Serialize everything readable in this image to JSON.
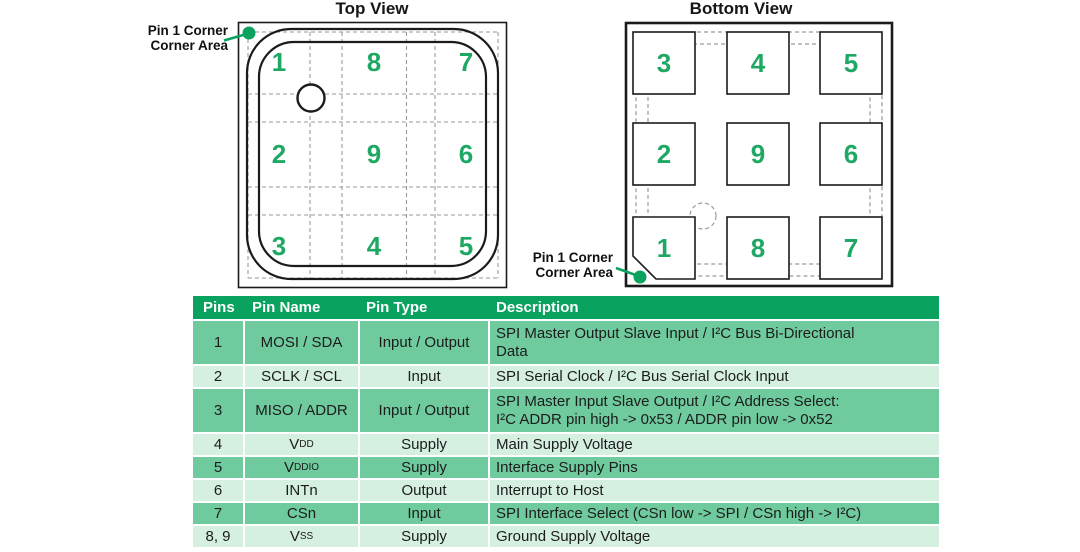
{
  "titles": {
    "top": "Top View",
    "bottom": "Bottom View"
  },
  "corner_label": {
    "line1": "Pin 1 Corner",
    "line2": "Corner Area"
  },
  "top_view": {
    "pins": [
      [
        "1",
        "8",
        "7"
      ],
      [
        "2",
        "9",
        "6"
      ],
      [
        "3",
        "4",
        "5"
      ]
    ]
  },
  "bottom_view": {
    "pins": [
      [
        "3",
        "4",
        "5"
      ],
      [
        "2",
        "9",
        "6"
      ],
      [
        "1",
        "8",
        "7"
      ]
    ]
  },
  "colors": {
    "accent_green": "#0aa25f",
    "pin_number_green": "#1ea864",
    "row_green": "#6fcb9e",
    "row_light_green": "#d5f0e1"
  },
  "table": {
    "headers": [
      "Pins",
      "Pin Name",
      "Pin Type",
      "Description"
    ],
    "rows": [
      {
        "pins": "1",
        "name_base": "MOSI / SDA",
        "name_sub": "",
        "type": "Input / Output",
        "desc": "SPI Master Output Slave Input / I²C Bus Bi-Directional\nData"
      },
      {
        "pins": "2",
        "name_base": "SCLK / SCL",
        "name_sub": "",
        "type": "Input",
        "desc": "SPI Serial Clock / I²C Bus Serial Clock Input"
      },
      {
        "pins": "3",
        "name_base": "MISO / ADDR",
        "name_sub": "",
        "type": "Input / Output",
        "desc": "SPI Master Input Slave Output / I²C Address Select:\nI²C ADDR pin high -> 0x53 / ADDR pin low -> 0x52"
      },
      {
        "pins": "4",
        "name_base": "V",
        "name_sub": "DD",
        "type": "Supply",
        "desc": "Main Supply Voltage"
      },
      {
        "pins": "5",
        "name_base": "V",
        "name_sub": "DDIO",
        "type": "Supply",
        "desc": "Interface Supply Pins"
      },
      {
        "pins": "6",
        "name_base": "INTn",
        "name_sub": "",
        "type": "Output",
        "desc": "Interrupt to Host"
      },
      {
        "pins": "7",
        "name_base": "CSn",
        "name_sub": "",
        "type": "Input",
        "desc": "SPI Interface Select (CSn low -> SPI / CSn high -> I²C)"
      },
      {
        "pins": "8, 9",
        "name_base": "V",
        "name_sub": "SS",
        "type": "Supply",
        "desc": "Ground Supply Voltage"
      }
    ]
  }
}
